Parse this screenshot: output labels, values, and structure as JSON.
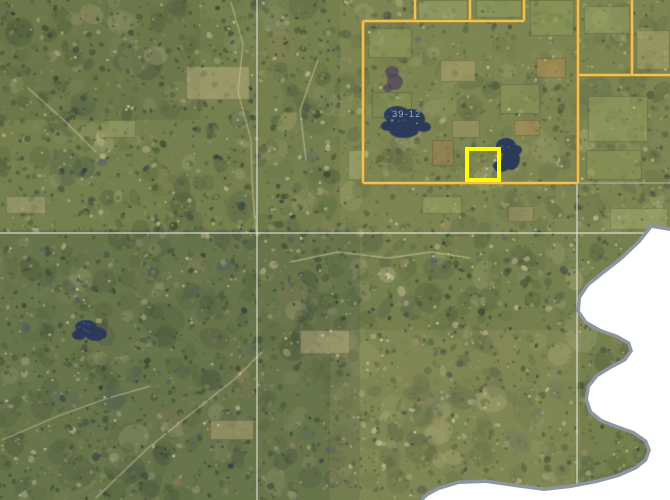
{
  "app": {
    "name": "aerial-parcel-map-view"
  },
  "map": {
    "width": 670,
    "height": 500,
    "colors": {
      "terrain_base": "#75804e",
      "boundary_inner": "#f2c24e",
      "boundary_outer": "#c68c2c",
      "selection_yellow": "#ffff00",
      "section_line": "#ebebe0",
      "lake_dark": "#2a3a58",
      "lake_spark": "#4c648e",
      "water_white": "#ffffff",
      "shore_gray": "#8d95a2"
    },
    "texture": {
      "seed": 7,
      "base": "#75804e",
      "palette": [
        {
          "c": "#4b5a39",
          "w": 15
        },
        {
          "c": "#3d4a32",
          "w": 11
        },
        {
          "c": "#5d6b42",
          "w": 14
        },
        {
          "c": "#6e7a4a",
          "w": 12
        },
        {
          "c": "#7b855a",
          "w": 8
        },
        {
          "c": "#8a9168",
          "w": 6
        },
        {
          "c": "#434e44",
          "w": 8
        },
        {
          "c": "#333f3b",
          "w": 5
        },
        {
          "c": "#a7a67b",
          "w": 6
        },
        {
          "c": "#c0b68a",
          "w": 5
        },
        {
          "c": "#d0c69a",
          "w": 3
        },
        {
          "c": "#96855e",
          "w": 3
        },
        {
          "c": "#56636f",
          "w": 2
        }
      ],
      "layers": [
        {
          "n": 900,
          "rmin": 6,
          "rmax": 18,
          "amin": 0.15,
          "amax": 0.32
        },
        {
          "n": 4300,
          "rmin": 1,
          "rmax": 4.5,
          "amin": 0.4,
          "amax": 0.85
        }
      ],
      "flecks": 750,
      "tints": [
        {
          "x": 340,
          "y": 0,
          "w": 330,
          "h": 235,
          "color": "rgba(160,158,98,0.20)"
        },
        {
          "x": 0,
          "y": 230,
          "w": 360,
          "h": 270,
          "color": "rgba(52,66,60,0.18)"
        },
        {
          "x": 330,
          "y": 330,
          "w": 250,
          "h": 170,
          "color": "rgba(190,175,120,0.14)"
        },
        {
          "x": 0,
          "y": 0,
          "w": 200,
          "h": 120,
          "color": "rgba(60,72,50,0.15)"
        }
      ]
    },
    "fields": [
      [
        368,
        28,
        44,
        30,
        "#8f9a5d"
      ],
      [
        418,
        0,
        50,
        20,
        "#9aa562"
      ],
      [
        476,
        0,
        46,
        18,
        "#93a05e"
      ],
      [
        530,
        0,
        44,
        36,
        "#8e9a58"
      ],
      [
        584,
        6,
        46,
        28,
        "#99a464"
      ],
      [
        636,
        30,
        34,
        40,
        "#a8a269"
      ],
      [
        372,
        92,
        40,
        26,
        "#7f8c52"
      ],
      [
        440,
        60,
        36,
        22,
        "#b3a46f"
      ],
      [
        500,
        84,
        40,
        30,
        "#8d9859"
      ],
      [
        588,
        96,
        60,
        46,
        "#97a161"
      ],
      [
        586,
        150,
        56,
        30,
        "#8b9656"
      ],
      [
        610,
        208,
        58,
        22,
        "#a3a76d"
      ],
      [
        422,
        196,
        40,
        18,
        "#9aa362"
      ],
      [
        348,
        150,
        16,
        30,
        "#a8ab72"
      ],
      [
        452,
        120,
        28,
        18,
        "#a29b66"
      ],
      [
        536,
        58,
        30,
        20,
        "#b0894f"
      ],
      [
        514,
        120,
        26,
        16,
        "#ad8d55"
      ],
      [
        432,
        140,
        22,
        26,
        "#a08050"
      ],
      [
        508,
        206,
        26,
        16,
        "#a2936a"
      ],
      [
        186,
        66,
        64,
        34,
        "#b5ab7e"
      ],
      [
        6,
        196,
        40,
        18,
        "#a8a476"
      ],
      [
        300,
        330,
        50,
        24,
        "#b3a87c"
      ],
      [
        210,
        420,
        44,
        20,
        "#ac9f72"
      ],
      [
        100,
        120,
        36,
        18,
        "#9aa06a"
      ]
    ],
    "trails": {
      "color": "#d9d0a0",
      "width": 1.3,
      "opacity": 0.55,
      "paths": [
        [
          [
            231,
            2
          ],
          [
            243,
            44
          ],
          [
            238,
            92
          ],
          [
            251,
            140
          ],
          [
            252,
            182
          ],
          [
            256,
            232
          ]
        ],
        [
          [
            96,
            498
          ],
          [
            148,
            448
          ],
          [
            198,
            408
          ],
          [
            236,
            378
          ],
          [
            262,
            352
          ]
        ],
        [
          [
            2,
            440
          ],
          [
            58,
            416
          ],
          [
            108,
            398
          ],
          [
            150,
            386
          ]
        ],
        [
          [
            290,
            262
          ],
          [
            338,
            252
          ],
          [
            388,
            258
          ],
          [
            432,
            252
          ],
          [
            470,
            258
          ]
        ],
        [
          [
            28,
            88
          ],
          [
            66,
            122
          ],
          [
            96,
            152
          ]
        ],
        [
          [
            318,
            60
          ],
          [
            300,
            110
          ],
          [
            306,
            160
          ]
        ]
      ]
    },
    "dark_lakes": {
      "color": "#2a3a58",
      "spark": "#4c648e",
      "items": [
        {
          "blobs": [
            [
              397,
              115,
              13,
              9
            ],
            [
              411,
              119,
              14,
              10
            ],
            [
              404,
              130,
              15,
              8
            ],
            [
              424,
              127,
              7,
              5
            ],
            [
              388,
              126,
              7,
              5
            ]
          ]
        },
        {
          "blobs": [
            [
              506,
              146,
              10,
              8
            ],
            [
              511,
              159,
              9,
              11
            ],
            [
              501,
              166,
              8,
              6
            ],
            [
              516,
              150,
              6,
              5
            ]
          ]
        },
        {
          "blobs": [
            [
              86,
              327,
              11,
              7
            ],
            [
              96,
              334,
              11,
              7
            ],
            [
              79,
              335,
              7,
              5
            ]
          ]
        }
      ]
    },
    "purple_patch": {
      "color": "#4e3f5e",
      "opacity": 0.7,
      "blobs": [
        [
          392,
          72,
          7,
          6
        ],
        [
          395,
          82,
          8,
          8
        ],
        [
          388,
          88,
          5,
          4
        ]
      ]
    },
    "section_lines": {
      "color": "#ebebe0",
      "width": 1.2,
      "segments": [
        {
          "pts": [
            [
              0,
              233
            ],
            [
              670,
              233
            ]
          ],
          "opacity": 0.85
        },
        {
          "pts": [
            [
              257,
              0
            ],
            [
              257,
              500
            ]
          ],
          "opacity": 0.85
        },
        {
          "pts": [
            [
              577,
              183
            ],
            [
              577,
              500
            ]
          ],
          "opacity": 0.85
        },
        {
          "pts": [
            [
              578,
              183
            ],
            [
              670,
              183
            ]
          ],
          "opacity": 0.45
        }
      ]
    },
    "water": {
      "fill": "#ffffff",
      "shore": "#8d95a2",
      "shore_width": 7,
      "points": [
        [
          670,
          231
        ],
        [
          652,
          228
        ],
        [
          640,
          243
        ],
        [
          622,
          260
        ],
        [
          604,
          274
        ],
        [
          589,
          286
        ],
        [
          581,
          298
        ],
        [
          580,
          311
        ],
        [
          587,
          321
        ],
        [
          601,
          329
        ],
        [
          618,
          335
        ],
        [
          630,
          342
        ],
        [
          633,
          351
        ],
        [
          626,
          361
        ],
        [
          611,
          369
        ],
        [
          598,
          377
        ],
        [
          590,
          387
        ],
        [
          588,
          399
        ],
        [
          592,
          411
        ],
        [
          602,
          419
        ],
        [
          617,
          425
        ],
        [
          634,
          431
        ],
        [
          647,
          440
        ],
        [
          651,
          450
        ],
        [
          647,
          461
        ],
        [
          637,
          469
        ],
        [
          619,
          477
        ],
        [
          597,
          483
        ],
        [
          571,
          488
        ],
        [
          544,
          491
        ],
        [
          514,
          487
        ],
        [
          486,
          483
        ],
        [
          459,
          484
        ],
        [
          439,
          490
        ],
        [
          428,
          496
        ],
        [
          424,
          500
        ],
        [
          670,
          500
        ]
      ]
    },
    "boundary": {
      "inner_color": "#f2c24e",
      "outer_color": "#c68c2c",
      "inner_width": 2.3,
      "outer_width": 4,
      "segments": [
        [
          [
            415,
            0
          ],
          [
            415,
            21
          ]
        ],
        [
          [
            470,
            0
          ],
          [
            470,
            21
          ]
        ],
        [
          [
            524,
            0
          ],
          [
            524,
            21
          ]
        ],
        [
          [
            363,
            21
          ],
          [
            524,
            21
          ]
        ],
        [
          [
            363,
            21
          ],
          [
            363,
            183
          ]
        ],
        [
          [
            363,
            183
          ],
          [
            578,
            183
          ]
        ],
        [
          [
            578,
            0
          ],
          [
            578,
            183
          ]
        ],
        [
          [
            578,
            75
          ],
          [
            670,
            75
          ]
        ],
        [
          [
            632,
            0
          ],
          [
            632,
            75
          ]
        ]
      ]
    },
    "selection": {
      "x": 467,
      "y": 149,
      "w": 32,
      "h": 31,
      "color": "#ffff00",
      "width": 4
    },
    "label": {
      "text": "39-12",
      "x": 392,
      "y": 117,
      "color": "#c3cedd",
      "opacity": 0.75,
      "size": 9.5,
      "spacing": 1
    }
  }
}
